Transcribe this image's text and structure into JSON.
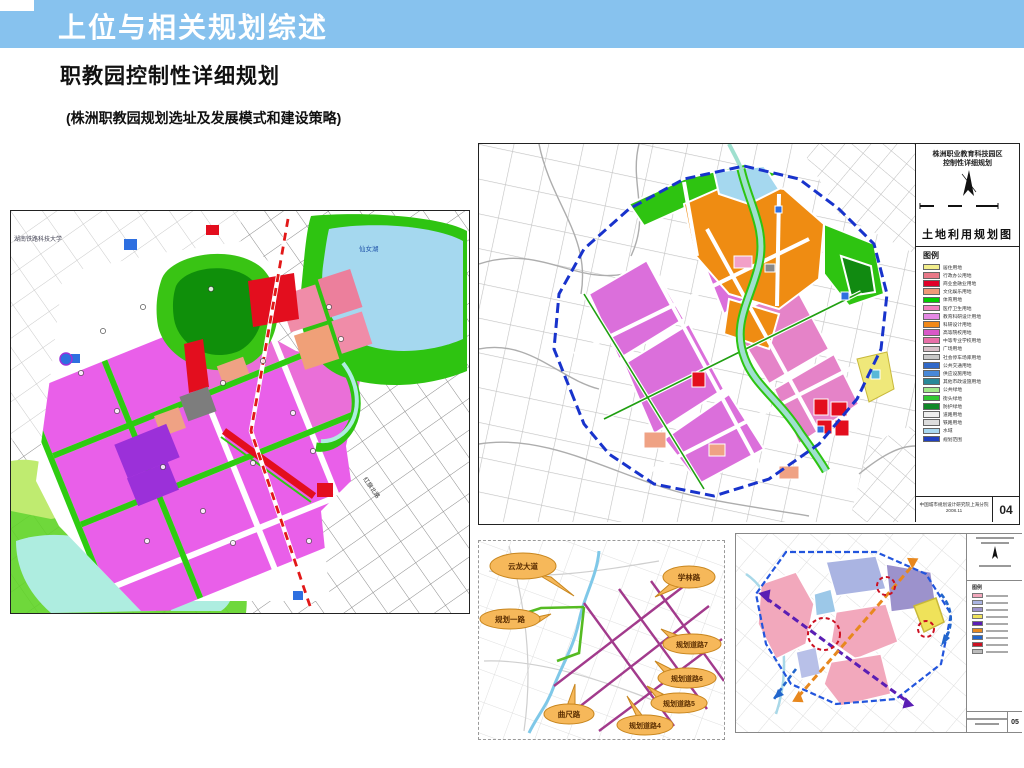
{
  "slide": {
    "banner_title": "上位与相关规划综述",
    "subtitle": "职教园控制性详细规划",
    "note": "(株洲职教园规划选址及发展模式和建设策略)",
    "banner_color": "#87C2EE"
  },
  "left_map": {
    "label_university": "湖南铁路科技大学",
    "label_lake": "仙女湖",
    "label_road": "红旗北路"
  },
  "right_map": {
    "title_line1": "株洲职业教育科技园区",
    "title_line2": "控制性详细规划",
    "map_name": "土地利用规划图",
    "legend_title": "图例",
    "legend": [
      {
        "label": "居住用地",
        "color": "#F2EE8C"
      },
      {
        "label": "行政办公用地",
        "color": "#E87888"
      },
      {
        "label": "商业金融业用地",
        "color": "#E00028"
      },
      {
        "label": "文化娱乐用地",
        "color": "#F09878"
      },
      {
        "label": "体育用地",
        "color": "#00CC00"
      },
      {
        "label": "医疗卫生用地",
        "color": "#F080C0"
      },
      {
        "label": "教育科研设计用地",
        "color": "#E488E4"
      },
      {
        "label": "科研设计用地",
        "color": "#F08818"
      },
      {
        "label": "高等院校用地",
        "color": "#D858C8"
      },
      {
        "label": "中等专业学校用地",
        "color": "#E86FA8"
      },
      {
        "label": "广场用地",
        "color": "#D8C0C8"
      },
      {
        "label": "社会停车场库用地",
        "color": "#C8C8C8"
      },
      {
        "label": "公共交通用地",
        "color": "#3068C8"
      },
      {
        "label": "供应设施用地",
        "color": "#4888D8"
      },
      {
        "label": "其他市政设施用地",
        "color": "#288898"
      },
      {
        "label": "公共绿地",
        "color": "#A0E888"
      },
      {
        "label": "街头绿地",
        "color": "#30C830"
      },
      {
        "label": "防护绿地",
        "color": "#108828"
      },
      {
        "label": "道路用地",
        "color": "#EEEEEE"
      },
      {
        "label": "铁路用地",
        "color": "#DDDDDD"
      },
      {
        "label": "水域",
        "color": "#A8D8F0"
      },
      {
        "label": "规划范围",
        "color": "#2040C0"
      }
    ],
    "credit": "中国城市规划设计研究院上海分院",
    "date": "2008.11",
    "page": "04"
  },
  "road_diagram": {
    "bubble_fill": "#F6B85A",
    "bubbles": [
      {
        "label": "云龙大道"
      },
      {
        "label": "学林路"
      },
      {
        "label": "规划一路"
      },
      {
        "label": "规划道路7"
      },
      {
        "label": "规划道路6"
      },
      {
        "label": "规划道路5"
      },
      {
        "label": "规划道路4"
      },
      {
        "label": "曲尺路"
      }
    ]
  },
  "structure_map": {
    "legend_title": "图例",
    "legend_colors": [
      "#F2A8BC",
      "#AAB4E2",
      "#9C92CC",
      "#EFE25A",
      "#5A1EB4",
      "#E8881E",
      "#2266CC",
      "#CC1122",
      "#BBBBBB"
    ],
    "page": "05"
  },
  "palette": {
    "edu_violet": "#E95FE9",
    "landuse_magenta": "#DB6FDB",
    "industry_orange": "#EF8C12",
    "green": "#2EC411",
    "dark_green": "#0F8F0A",
    "water_cyan": "#A8E8DC",
    "lake_blue": "#A5D8EF",
    "red": "#E30E1E",
    "salmon": "#EFA284",
    "boundary_blue": "#1833CC"
  }
}
